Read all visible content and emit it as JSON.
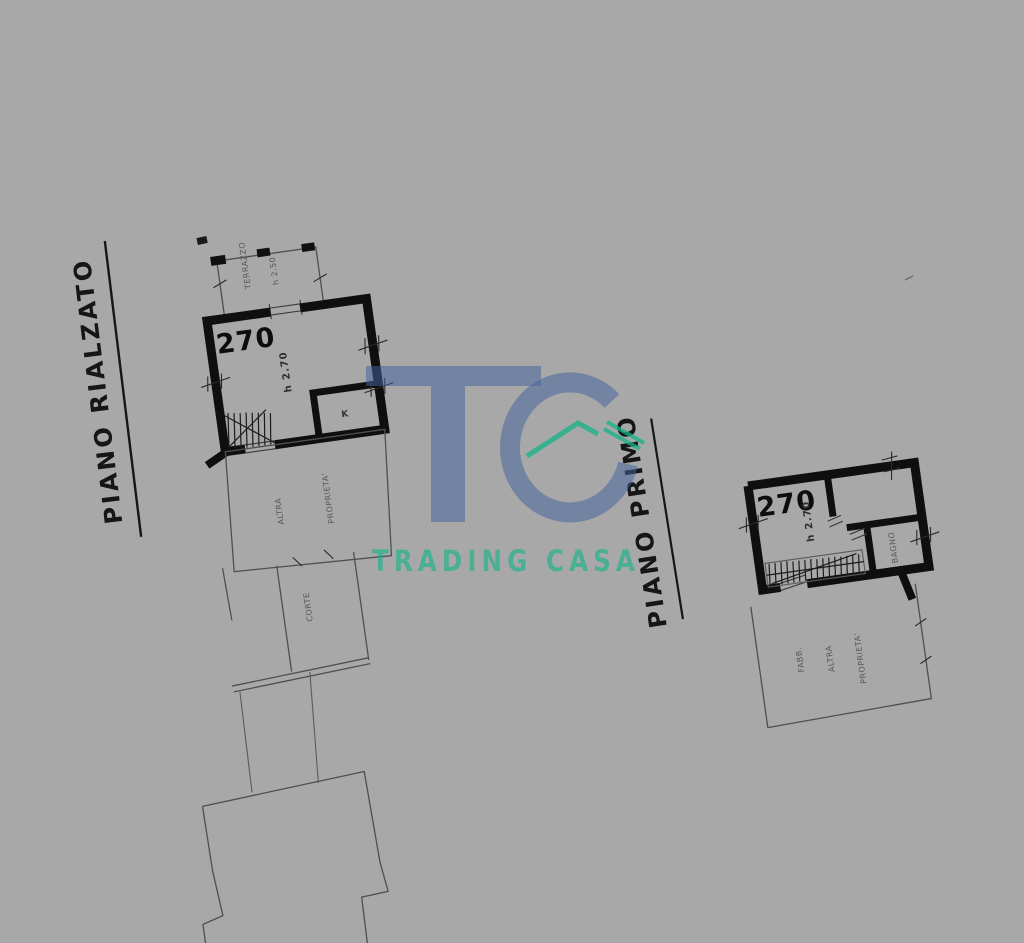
{
  "watermark": {
    "monogram": "TC",
    "name": "TRADING CASA"
  },
  "floor1": {
    "title": "PIANO RIALZATO",
    "room_number": "270",
    "room_height": "h 2.70",
    "terrace_label": "TERRAZZO",
    "terrace_height": "h 2.50",
    "kitchen_label": "K",
    "annex_label_1": "ALTRA",
    "annex_label_2": "PROPRIETA'",
    "court_label": "CORTE"
  },
  "floor2": {
    "title": "PIANO PRIMO",
    "room_number": "270",
    "room_height": "h 2.70",
    "bath_label": "BAGNO",
    "annex_label_1": "FABB.",
    "annex_label_2": "ALTRA",
    "annex_label_3": "PROPRIETA'"
  },
  "colors": {
    "background": "#a8a8a8",
    "ink": "#0f0f0f",
    "faded_line": "#4f4f4f",
    "watermark_blue": "#44639f",
    "watermark_teal": "#12b487"
  }
}
